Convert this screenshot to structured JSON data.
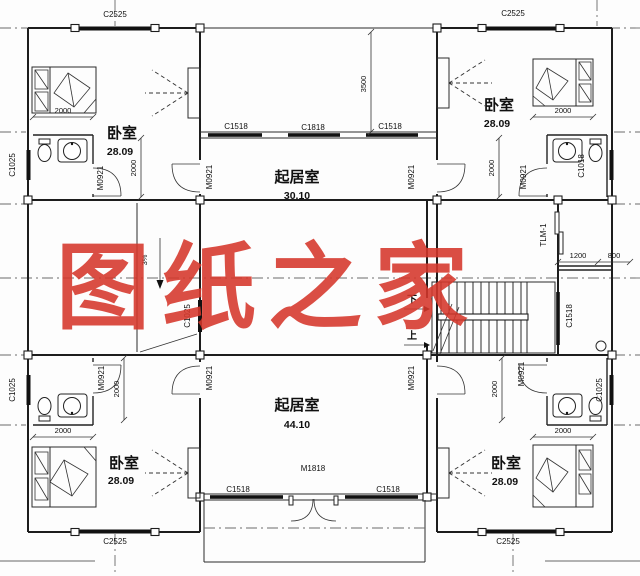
{
  "watermark": {
    "text": "图纸之家",
    "color": "#d6372b"
  },
  "rooms": {
    "bedroom": {
      "name": "卧室",
      "area": "28.09"
    },
    "living_upper": {
      "name": "起居室",
      "area": "30.10"
    },
    "living_lower": {
      "name": "起居室",
      "area": "44.10"
    }
  },
  "windows": {
    "c2525": "C2525",
    "c1518": "C1518",
    "c1818": "C1818",
    "c1025": "C1025",
    "c1018": "C1018"
  },
  "doors": {
    "m0921": "M0921",
    "m1818": "M1818",
    "tlm1": "TLM-1"
  },
  "dimensions": {
    "terrace_depth": "3500",
    "bed_length": "2000",
    "stair_a": "1200",
    "stair_b": "800",
    "slope": "3%"
  },
  "stair": {
    "down": "下",
    "up": "上"
  },
  "colors": {
    "line": "#1d1d1d",
    "background": "#ffffff"
  }
}
